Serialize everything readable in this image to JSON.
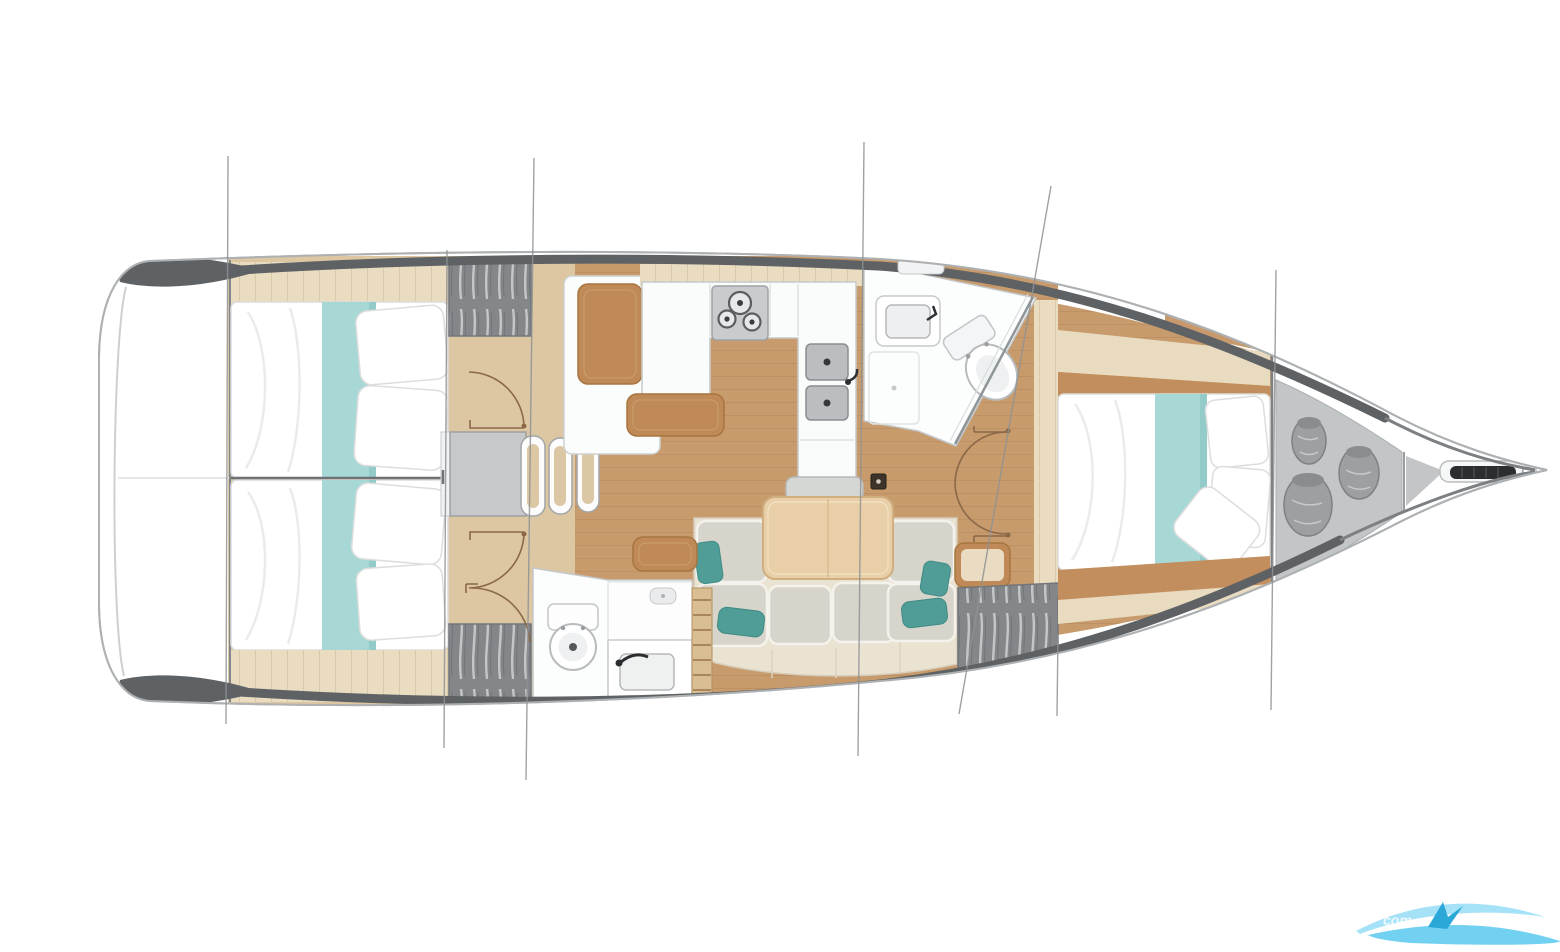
{
  "diagram": {
    "title": "Sailing yacht interior layout plan, top-down view, bow pointing right",
    "type": "boat-floor-plan",
    "orientation": {
      "bow": "right",
      "stern": "left"
    },
    "areas": [
      {
        "id": "stern-lazarette",
        "label": "stern / transom area"
      },
      {
        "id": "aft-cabin-port",
        "label": "aft double cabin (top)"
      },
      {
        "id": "aft-cabin-starboard",
        "label": "aft double cabin (bottom)"
      },
      {
        "id": "companionway-steps",
        "label": "companionway steps"
      },
      {
        "id": "galley",
        "label": "L-galley with 3-burner stove and double sink"
      },
      {
        "id": "aft-head",
        "label": "aft head with toilet and washbasin"
      },
      {
        "id": "salon",
        "label": "salon with dining table and C-shaped settee"
      },
      {
        "id": "forward-head",
        "label": "forward head with toilet and washbasin"
      },
      {
        "id": "forward-cabin",
        "label": "forward double cabin"
      },
      {
        "id": "sail-locker",
        "label": "bow sail locker with sail bags"
      },
      {
        "id": "bow-fitting",
        "label": "bow anchor roller fitting"
      }
    ],
    "features": {
      "double_berths": 3,
      "heads": 2,
      "stove_burners": 3,
      "galley_sinks": 2,
      "sail_bags": 3,
      "hanging_lockers": 3,
      "rig_stay_lines": 7,
      "door_swings": 5
    },
    "colors": {
      "hull_outline": "#adb1b3",
      "deck_band": "#5e6265",
      "floor_teak": "#c79b6c",
      "floor_light_plank": "#e9dcc1",
      "floor_companionway": "#dcc7a2",
      "furniture_tan": "#bf8a57",
      "table_wood": "#e9cfa7",
      "cushion_gray": "#d7d4cb",
      "accent_teal_pillow": "#4f9d96",
      "bed_runner_teal": "#a7d8d6",
      "locker_gray": "#83878a",
      "fixture_white": "#fcfdfd",
      "watermark_blue": "#59c9ef"
    },
    "watermark": {
      "text": "com"
    }
  }
}
